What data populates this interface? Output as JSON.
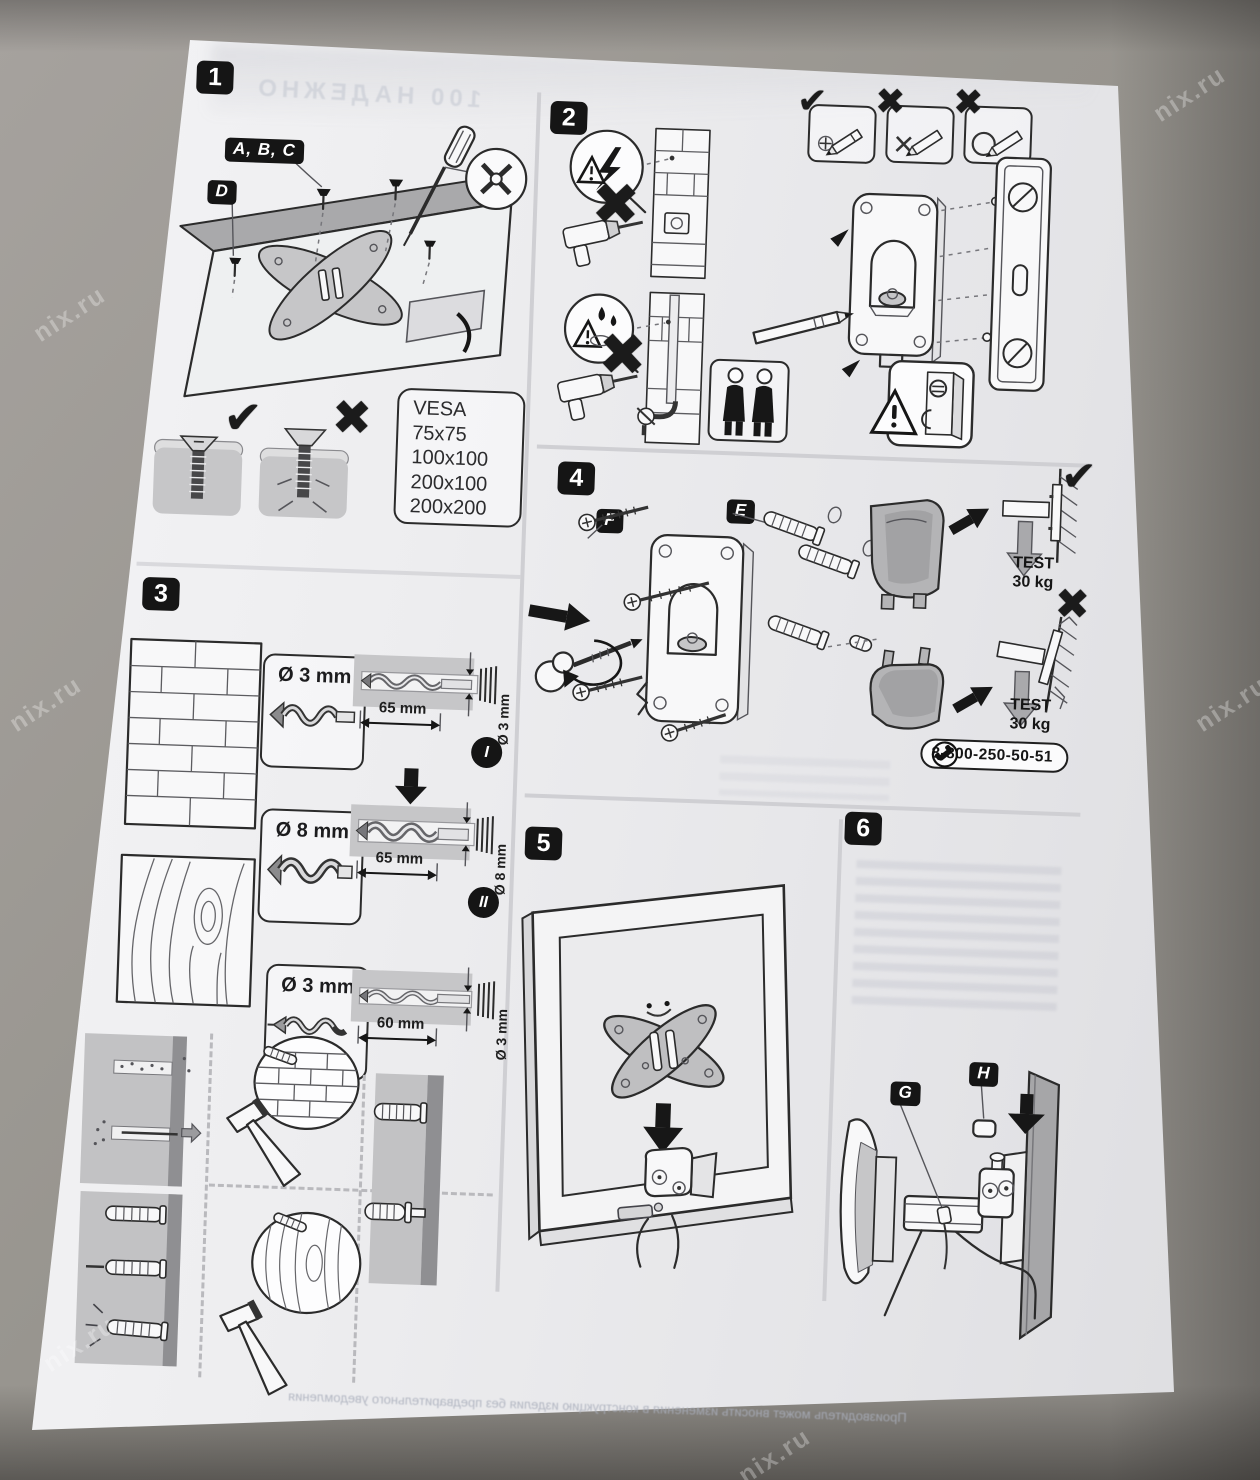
{
  "watermark": {
    "text": "nix.ru"
  },
  "icons": {
    "check": "✔",
    "cross": "✖"
  },
  "bleed": {
    "top": "100 НАДЕЖНО",
    "bottom": "Производитель может вносить изменения в конструкцию изделия без предварительного уведомления"
  },
  "panel1": {
    "badge": "1",
    "label_abc": "A, B, C",
    "label_d": "D",
    "vesa_title": "VESA",
    "vesa_sizes": [
      "75x75",
      "100x100",
      "200x100",
      "200x200"
    ]
  },
  "panel2": {
    "badge": "2"
  },
  "panel3": {
    "badge": "3",
    "rows": [
      {
        "bit": "Ø 3 mm",
        "depth": "65 mm",
        "dia": "Ø 3 mm",
        "tag": "I"
      },
      {
        "bit": "Ø 8 mm",
        "depth": "65 mm",
        "dia": "Ø 8 mm",
        "tag": "II"
      },
      {
        "bit": "Ø 3 mm",
        "depth": "60 mm",
        "dia": "Ø 3 mm"
      }
    ]
  },
  "panel4": {
    "badge": "4",
    "label_f": "F",
    "label_e": "E",
    "test_line1": "TEST",
    "test_line2": "30 kg",
    "phone": "8-800-250-50-51"
  },
  "panel5": {
    "badge": "5"
  },
  "panel6": {
    "badge": "6",
    "label_g": "G",
    "label_h": "H"
  }
}
